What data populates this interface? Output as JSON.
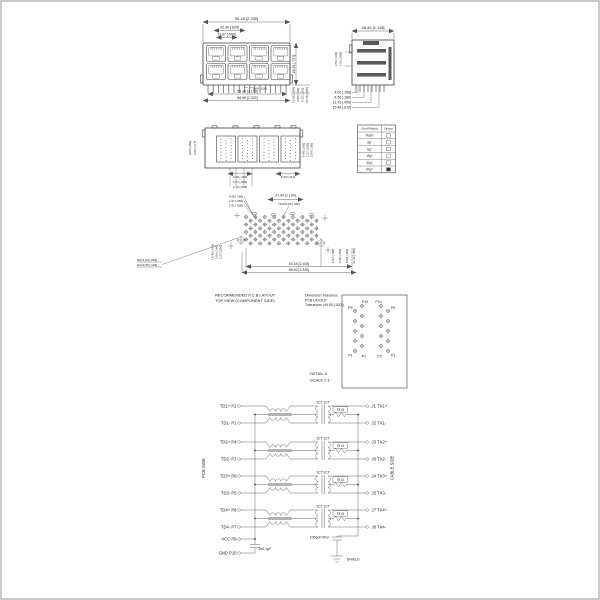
{
  "front_view": {
    "dim_overall_width": "59.18 [2.330]",
    "dim_port_pitch": "20.96 [.825]",
    "dim_port_width": "13.97 [.550]",
    "dim_pin": "0.66 [.026]",
    "dim_pin_span": "53.34 [2.100]",
    "dim_body_width": "58.98 [2.322]",
    "dim_r1": "10.00 [.394]",
    "dim_r2": "3.50 [.138]",
    "dim_r3": "4.10 [.161]",
    "dim_r4": "20.70 [.815]",
    "dim_height": "20.24 [.797]"
  },
  "side_view": {
    "dim_depth": "28.49 [1.118]",
    "dim_l1": "3.56 [.140]",
    "dim_l2": "1.52 [.060]",
    "dim_b1": "4.00 [.158]",
    "dim_b2": "4.56 [.180]",
    "dim_b3": "11.43 [.450]",
    "dim_b4": "15.49 [.610]"
  },
  "bottom_view": {
    "dim_l1": "9.00 [.354]",
    "dim_l2": "4.50 [.177]",
    "dim_b1": "4.06 [.160]",
    "dim_b2": "1.27 [.050]",
    "dim_b3": "2.42 [.095]",
    "dim_b4": "5.40 [.213]",
    "dim_r1": "6.40 [.252]",
    "dim_r2": "1.27 [.050]",
    "dim_r3": "2.54 [.100]"
  },
  "plating_table": {
    "col1": "Gold Plating",
    "col2": "Option",
    "rows": [
      "Flash",
      "3µ\"",
      "6µ\"",
      "15µ\"",
      "30µ\"",
      "50µ\""
    ]
  },
  "pcb_layout": {
    "dim_t1": "4.06 [.160]",
    "dim_t2": "1.27 [.050]",
    "dim_t3": "2.41 [.095]",
    "dim_span": "27.94 [1.100]",
    "callout_pads": "72x∅0.90 [.035]",
    "callout_holes_8": "8x∅1.60 [.063]",
    "callout_holes_2": "2x∅3.25 [.128]",
    "dim_l1": "15.49 [.610]",
    "dim_l2": "3.54 [.140]",
    "dim_l3": "1.27 [.050]",
    "dim_r1": "4.57 [.180]",
    "dim_r2": "6.35 [.250]",
    "dim_r3": "8.89 [.350]",
    "dim_r4": "11.43 [.450]",
    "dim_b1": "53.34 [2.100]",
    "dim_b2": "58.92 [2.320]",
    "title_line1": "RECOMMENDED P.C.B LAYOUT",
    "title_line2": "TOP VIEW (COMPONENT SIDE)",
    "note_line1": "Dimension Tolerance:",
    "note_line2": "PCB LAYOUT",
    "note_line3": "Tolerances (±0.05 [.002])"
  },
  "detail_a": {
    "caption_line1": "DETAIL A",
    "caption_line2": "SCALE 2:1",
    "labels": {
      "tl": "P9",
      "tcl": "P10",
      "tcr": "P10",
      "tr": "P9",
      "bl": "P1",
      "bcl": "P2",
      "bcr": "P2",
      "br": "P1"
    }
  },
  "schematic": {
    "pcb_side_label": "PCB SIDE",
    "cable_side_label": "CABLE SIDE",
    "transformer_ratio": "1CT:1CT",
    "resistor_value": "75 Ω",
    "rows": [
      {
        "left": "TD1+ P2",
        "right": "J1 TX1+"
      },
      {
        "left": "TD1-  P1",
        "right": "J2 TX1-"
      },
      {
        "left": "TD2+ P4",
        "right": "J3 TX2+"
      },
      {
        "left": "TD2-  P3",
        "right": "J6 TX2-"
      },
      {
        "left": "TD3+ P6",
        "right": "J4 TX3+"
      },
      {
        "left": "TD3-  P5",
        "right": "J5 TX3-"
      },
      {
        "left": "TD4+ P8",
        "right": "J7 TX4+"
      },
      {
        "left": "TD4-  P7",
        "right": "J8 TX4-"
      }
    ],
    "vcc_label": "VCC  P9",
    "gnd_label": "GND P10",
    "cap_decoupling": "2x0.1µF",
    "cap_shield": "1000pF/2KV",
    "shield_label": "SHIELD"
  }
}
